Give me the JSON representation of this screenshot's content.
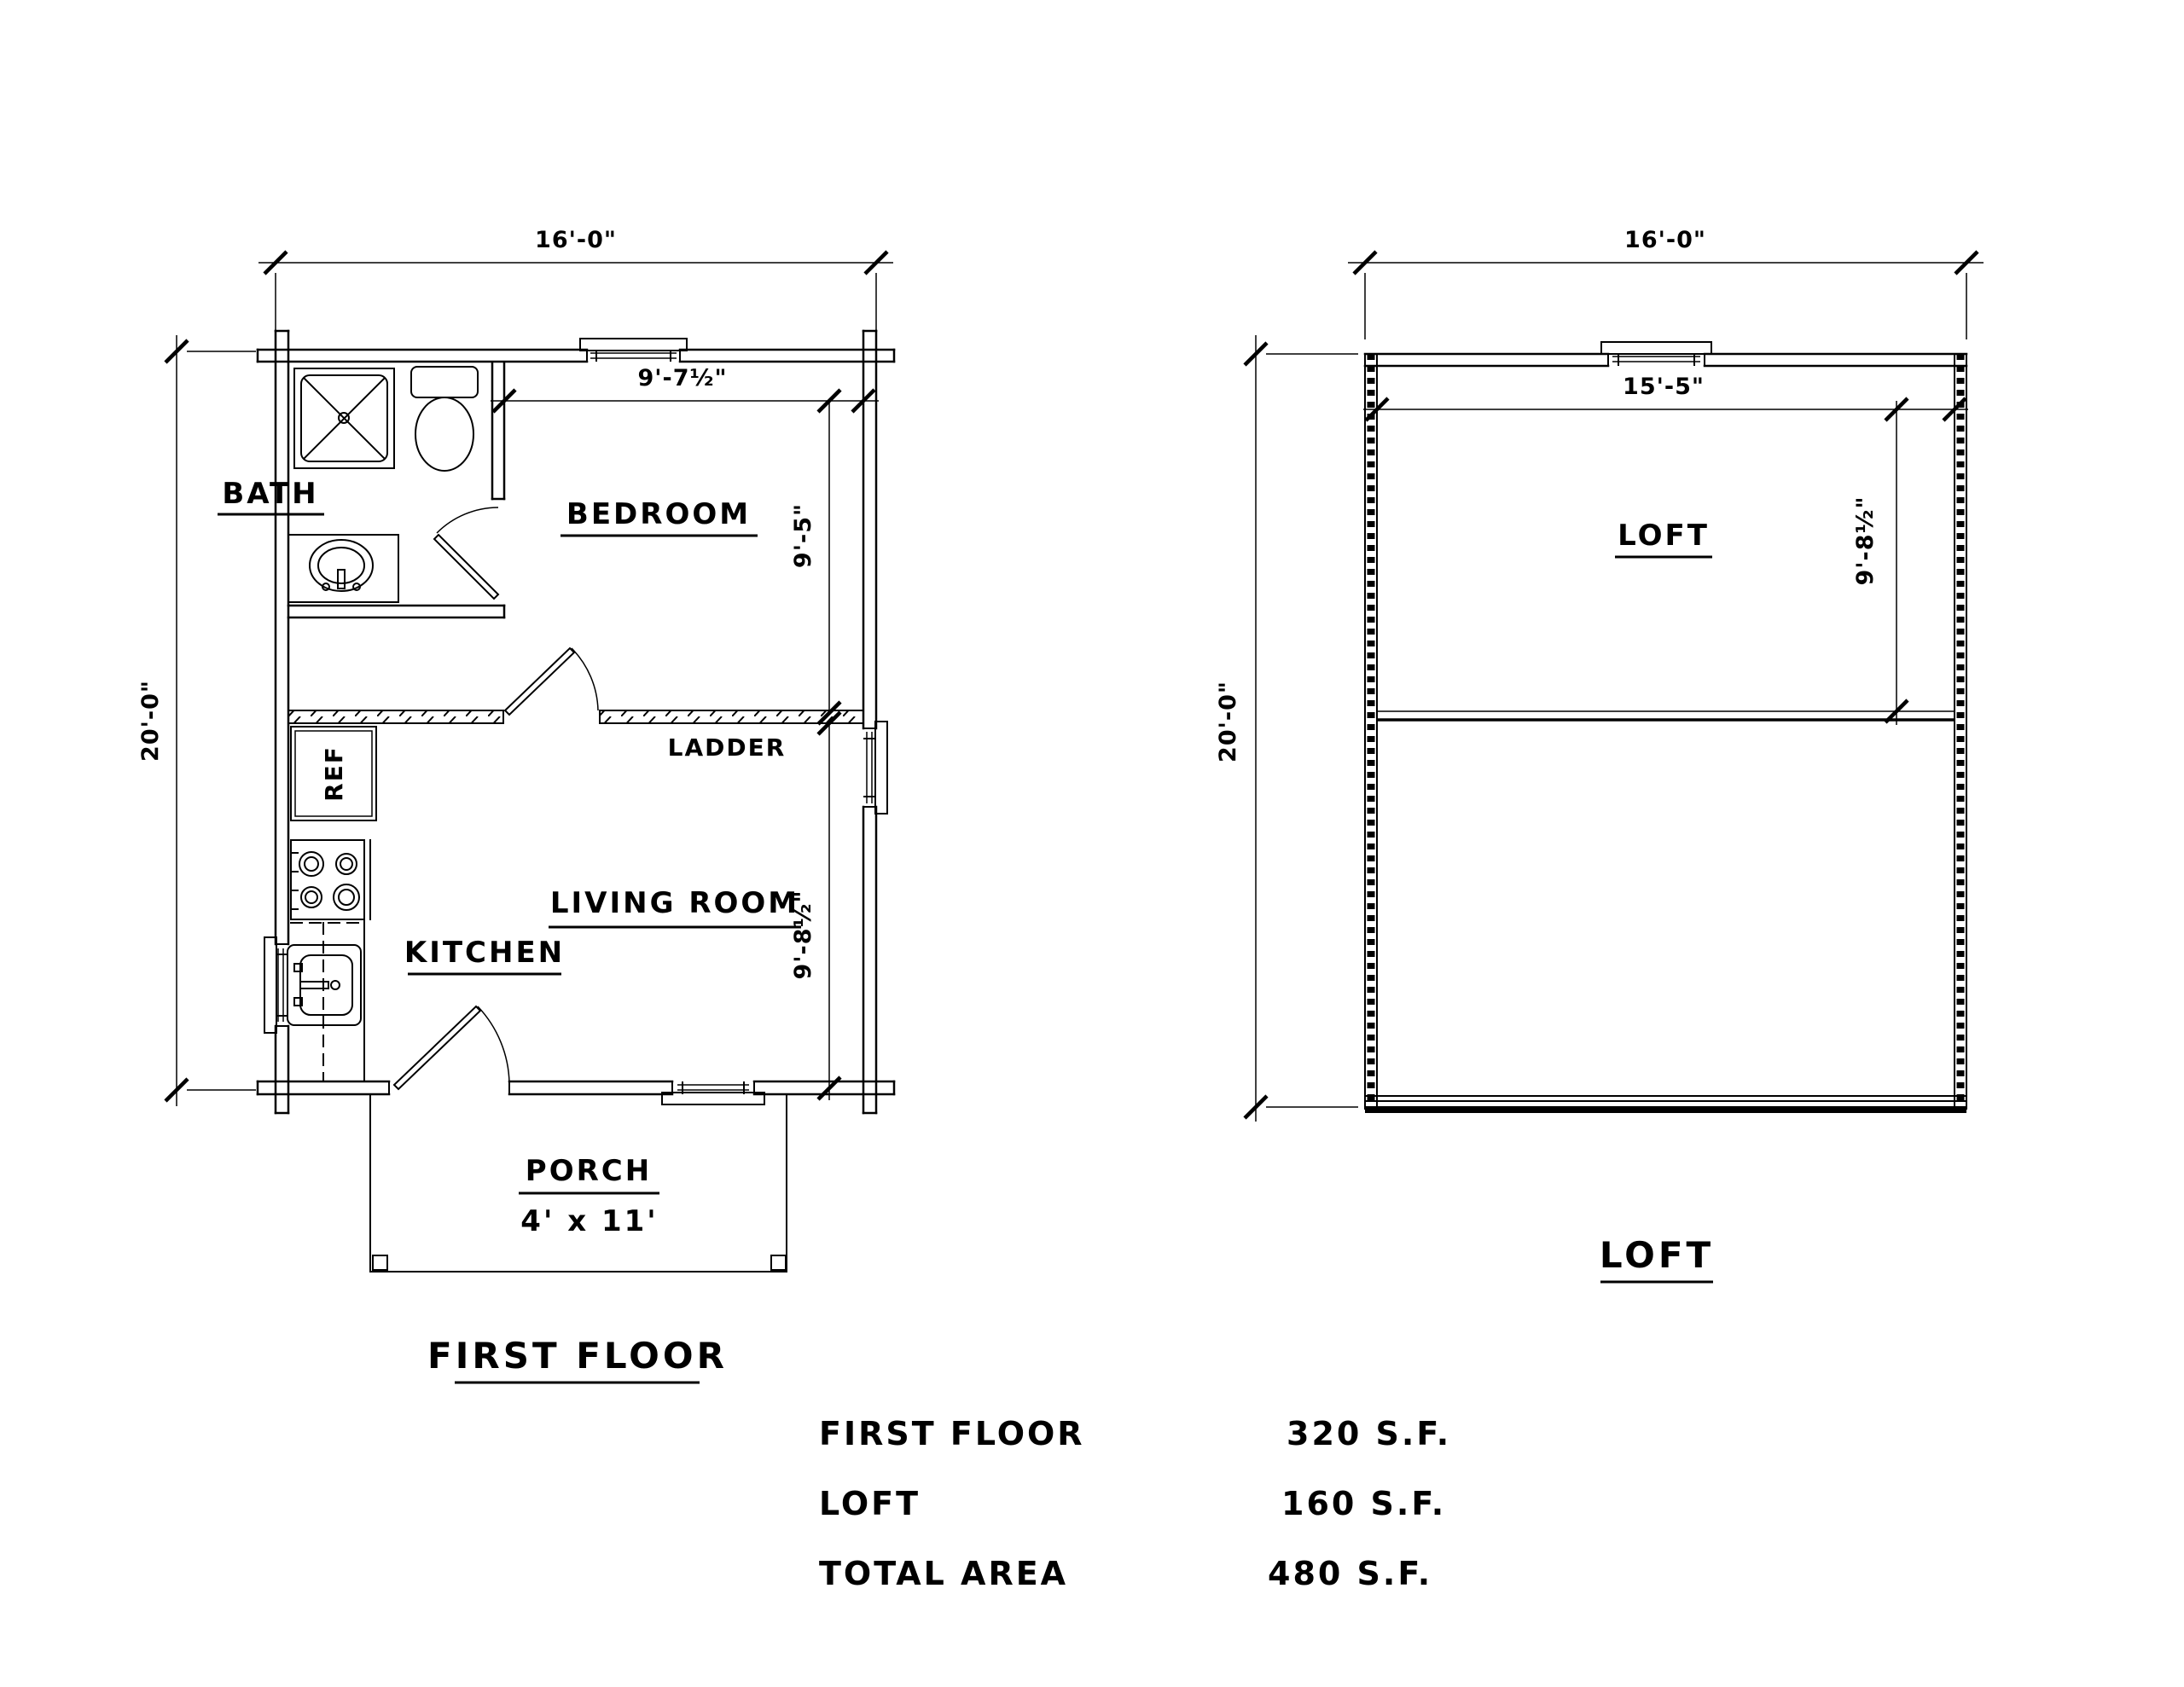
{
  "first_floor": {
    "title": "FIRST FLOOR",
    "dim_width": "16'-0\"",
    "dim_height": "20'-0\"",
    "dim_bedroom_width": "9'-7½\"",
    "dim_bedroom_depth": "9'-5\"",
    "dim_living_depth": "9'-8½\"",
    "rooms": {
      "bath": "BATH",
      "bedroom": "BEDROOM",
      "living_room": "LIVING ROOM",
      "kitchen": "KITCHEN",
      "porch": "PORCH",
      "ladder": "LADDER"
    },
    "labels": {
      "ref": "REF",
      "porch_size": "4' x 11'"
    }
  },
  "loft": {
    "title": "LOFT",
    "room_label": "LOFT",
    "dim_width": "16'-0\"",
    "dim_height": "20'-0\"",
    "dim_inner_width": "15'-5\"",
    "dim_upper_depth": "9'-8½\""
  },
  "summary": {
    "rows": [
      {
        "label": "FIRST FLOOR",
        "value": "320 S.F."
      },
      {
        "label": "LOFT",
        "value": "160 S.F."
      },
      {
        "label": "TOTAL AREA",
        "value": "480 S.F."
      }
    ]
  }
}
